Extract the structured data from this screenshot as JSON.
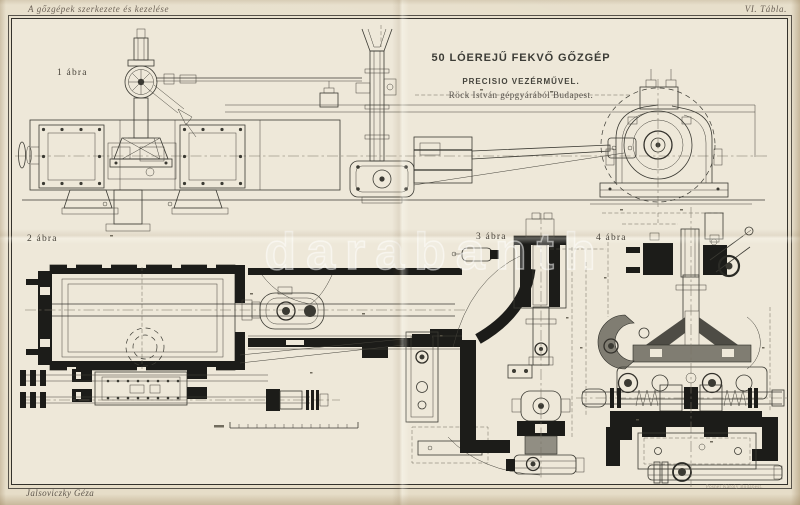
{
  "plate": {
    "series_title": "A gőzgépek szerkezete és kezelése",
    "plate_number": "VI. Tábla.",
    "title": "50 LÓEREJŰ FEKVŐ GŐZGÉP",
    "subtitle": "PRECISIO VEZÉRMŰVEL.",
    "credit": "Röck István gépgyárából Budapest.",
    "author": "Jalsoviczky Géza",
    "printer": "Posner Károly Budapest.",
    "watermark": "darabanth",
    "figures": [
      {
        "label": "1 ábra"
      },
      {
        "label": "2 ábra"
      },
      {
        "label": "3 ábra"
      },
      {
        "label": "4 ábra"
      }
    ],
    "colors": {
      "paper": "#e9e1cf",
      "paper_inner": "#eee8d9",
      "ink": "#3b3a33",
      "ink_heavy": "#1c1c19",
      "edge": "#cdbfa2"
    }
  }
}
